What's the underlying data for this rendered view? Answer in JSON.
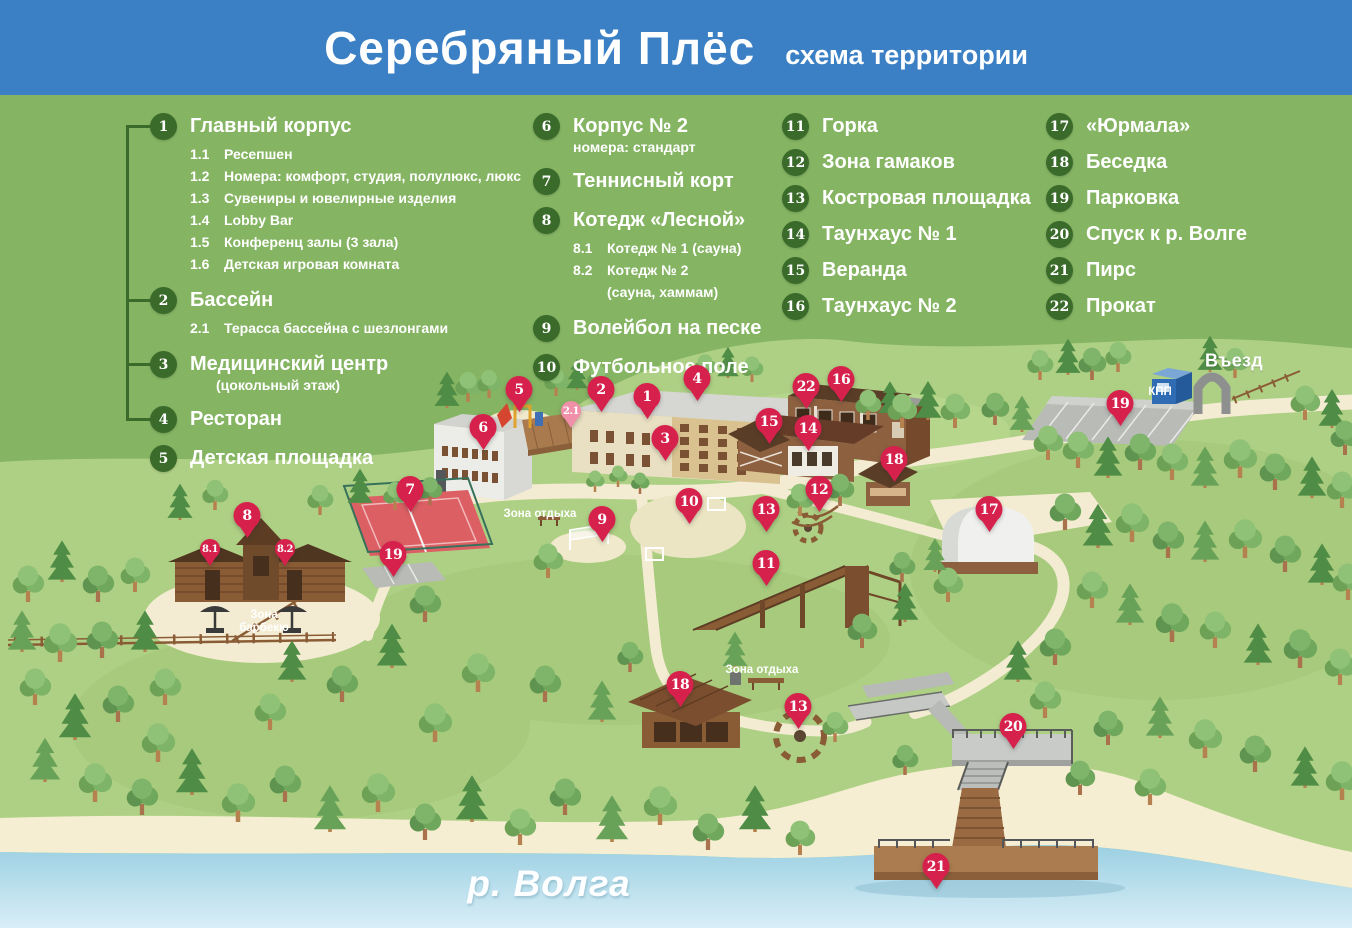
{
  "header": {
    "title": "Серебряный Плёс",
    "subtitle": "схема территории"
  },
  "colors": {
    "header_bg": "#3b80c4",
    "legend_bg": "#85b463",
    "map_bg": "#aed084",
    "pin": "#d6214d",
    "pin_light": "#ef8fa8",
    "legend_circle": "#3a6b2a",
    "path": "#f3ecd2",
    "water": "#9bd0e2"
  },
  "legend": {
    "columns": [
      {
        "items": [
          {
            "num": "1",
            "label": "Главный корпус",
            "bracket": true,
            "subs": [
              {
                "num": "1.1",
                "text": "Ресепшен"
              },
              {
                "num": "1.2",
                "text": "Номера: комфорт, студия, полулюкс, люкс"
              },
              {
                "num": "1.3",
                "text": "Сувениры и ювелирные изделия"
              },
              {
                "num": "1.4",
                "text": "Lobby Bar"
              },
              {
                "num": "1.5",
                "text": "Конференц залы (3 зала)"
              },
              {
                "num": "1.6",
                "text": "Детская игровая комната"
              }
            ]
          },
          {
            "num": "2",
            "label": "Бассейн",
            "bracket": true,
            "subs": [
              {
                "num": "2.1",
                "text": "Терасса бассейна с шезлонгами"
              }
            ]
          },
          {
            "num": "3",
            "label": "Медицинский центр",
            "note": "(цокольный этаж)",
            "bracket": true
          },
          {
            "num": "4",
            "label": "Ресторан",
            "bracket": true
          },
          {
            "num": "5",
            "label": "Детская площадка"
          }
        ]
      },
      {
        "items": [
          {
            "num": "6",
            "label": "Корпус № 2",
            "note": "номера: стандарт"
          },
          {
            "num": "7",
            "label": "Теннисный корт"
          },
          {
            "num": "8",
            "label": "Котедж «Лесной»",
            "subs": [
              {
                "num": "8.1",
                "text": "Котедж № 1 (сауна)"
              },
              {
                "num": "8.2",
                "text": "Котедж № 2\n(сауна, хаммам)"
              }
            ]
          },
          {
            "num": "9",
            "label": "Волейбол на песке"
          },
          {
            "num": "10",
            "label": "Футбольное поле"
          }
        ]
      },
      {
        "items": [
          {
            "num": "11",
            "label": "Горка"
          },
          {
            "num": "12",
            "label": "Зона гамаков"
          },
          {
            "num": "13",
            "label": "Костровая площадка"
          },
          {
            "num": "14",
            "label": "Таунхаус № 1"
          },
          {
            "num": "15",
            "label": "Веранда"
          },
          {
            "num": "16",
            "label": "Таунхаус № 2"
          }
        ]
      },
      {
        "items": [
          {
            "num": "17",
            "label": "«Юрмала»"
          },
          {
            "num": "18",
            "label": "Беседка"
          },
          {
            "num": "19",
            "label": "Парковка"
          },
          {
            "num": "20",
            "label": "Спуск к р. Волге"
          },
          {
            "num": "21",
            "label": "Пирс"
          },
          {
            "num": "22",
            "label": "Прокат"
          }
        ]
      }
    ]
  },
  "map": {
    "labels": [
      {
        "text": "Въезд",
        "x": 1234,
        "y": 361,
        "style": "lg"
      },
      {
        "text": "КПП",
        "x": 1160,
        "y": 392,
        "style": "sm"
      },
      {
        "text": "Зона отдыха",
        "x": 540,
        "y": 514,
        "style": "sm"
      },
      {
        "text": "Зона отдыха",
        "x": 762,
        "y": 670,
        "style": "sm"
      },
      {
        "text": "Зона барбекю",
        "x": 264,
        "y": 622,
        "style": "sm",
        "w": 64
      },
      {
        "text": "р. Волга",
        "x": 549,
        "y": 884,
        "style": "river"
      }
    ],
    "markers": [
      {
        "n": "5",
        "x": 519,
        "y": 412
      },
      {
        "n": "2.1",
        "x": 571,
        "y": 428,
        "size": "sm",
        "tone": "pink"
      },
      {
        "n": "2",
        "x": 601,
        "y": 412
      },
      {
        "n": "1",
        "x": 647,
        "y": 419
      },
      {
        "n": "4",
        "x": 697,
        "y": 401
      },
      {
        "n": "3",
        "x": 665,
        "y": 461
      },
      {
        "n": "6",
        "x": 483,
        "y": 450
      },
      {
        "n": "22",
        "x": 806,
        "y": 409
      },
      {
        "n": "16",
        "x": 841,
        "y": 402
      },
      {
        "n": "15",
        "x": 769,
        "y": 444
      },
      {
        "n": "14",
        "x": 808,
        "y": 451
      },
      {
        "n": "18",
        "x": 894,
        "y": 482
      },
      {
        "n": "12",
        "x": 819,
        "y": 512
      },
      {
        "n": "13",
        "x": 766,
        "y": 532
      },
      {
        "n": "10",
        "x": 689,
        "y": 524
      },
      {
        "n": "9",
        "x": 602,
        "y": 542
      },
      {
        "n": "7",
        "x": 410,
        "y": 512
      },
      {
        "n": "8",
        "x": 247,
        "y": 538
      },
      {
        "n": "8.1",
        "x": 210,
        "y": 566,
        "size": "sm"
      },
      {
        "n": "8.2",
        "x": 285,
        "y": 566,
        "size": "sm"
      },
      {
        "n": "19",
        "x": 393,
        "y": 577
      },
      {
        "n": "11",
        "x": 766,
        "y": 586
      },
      {
        "n": "17",
        "x": 989,
        "y": 532
      },
      {
        "n": "19",
        "x": 1120,
        "y": 426
      },
      {
        "n": "18",
        "x": 680,
        "y": 707
      },
      {
        "n": "13",
        "x": 798,
        "y": 729
      },
      {
        "n": "20",
        "x": 1013,
        "y": 749
      },
      {
        "n": "21",
        "x": 936,
        "y": 889
      }
    ]
  }
}
